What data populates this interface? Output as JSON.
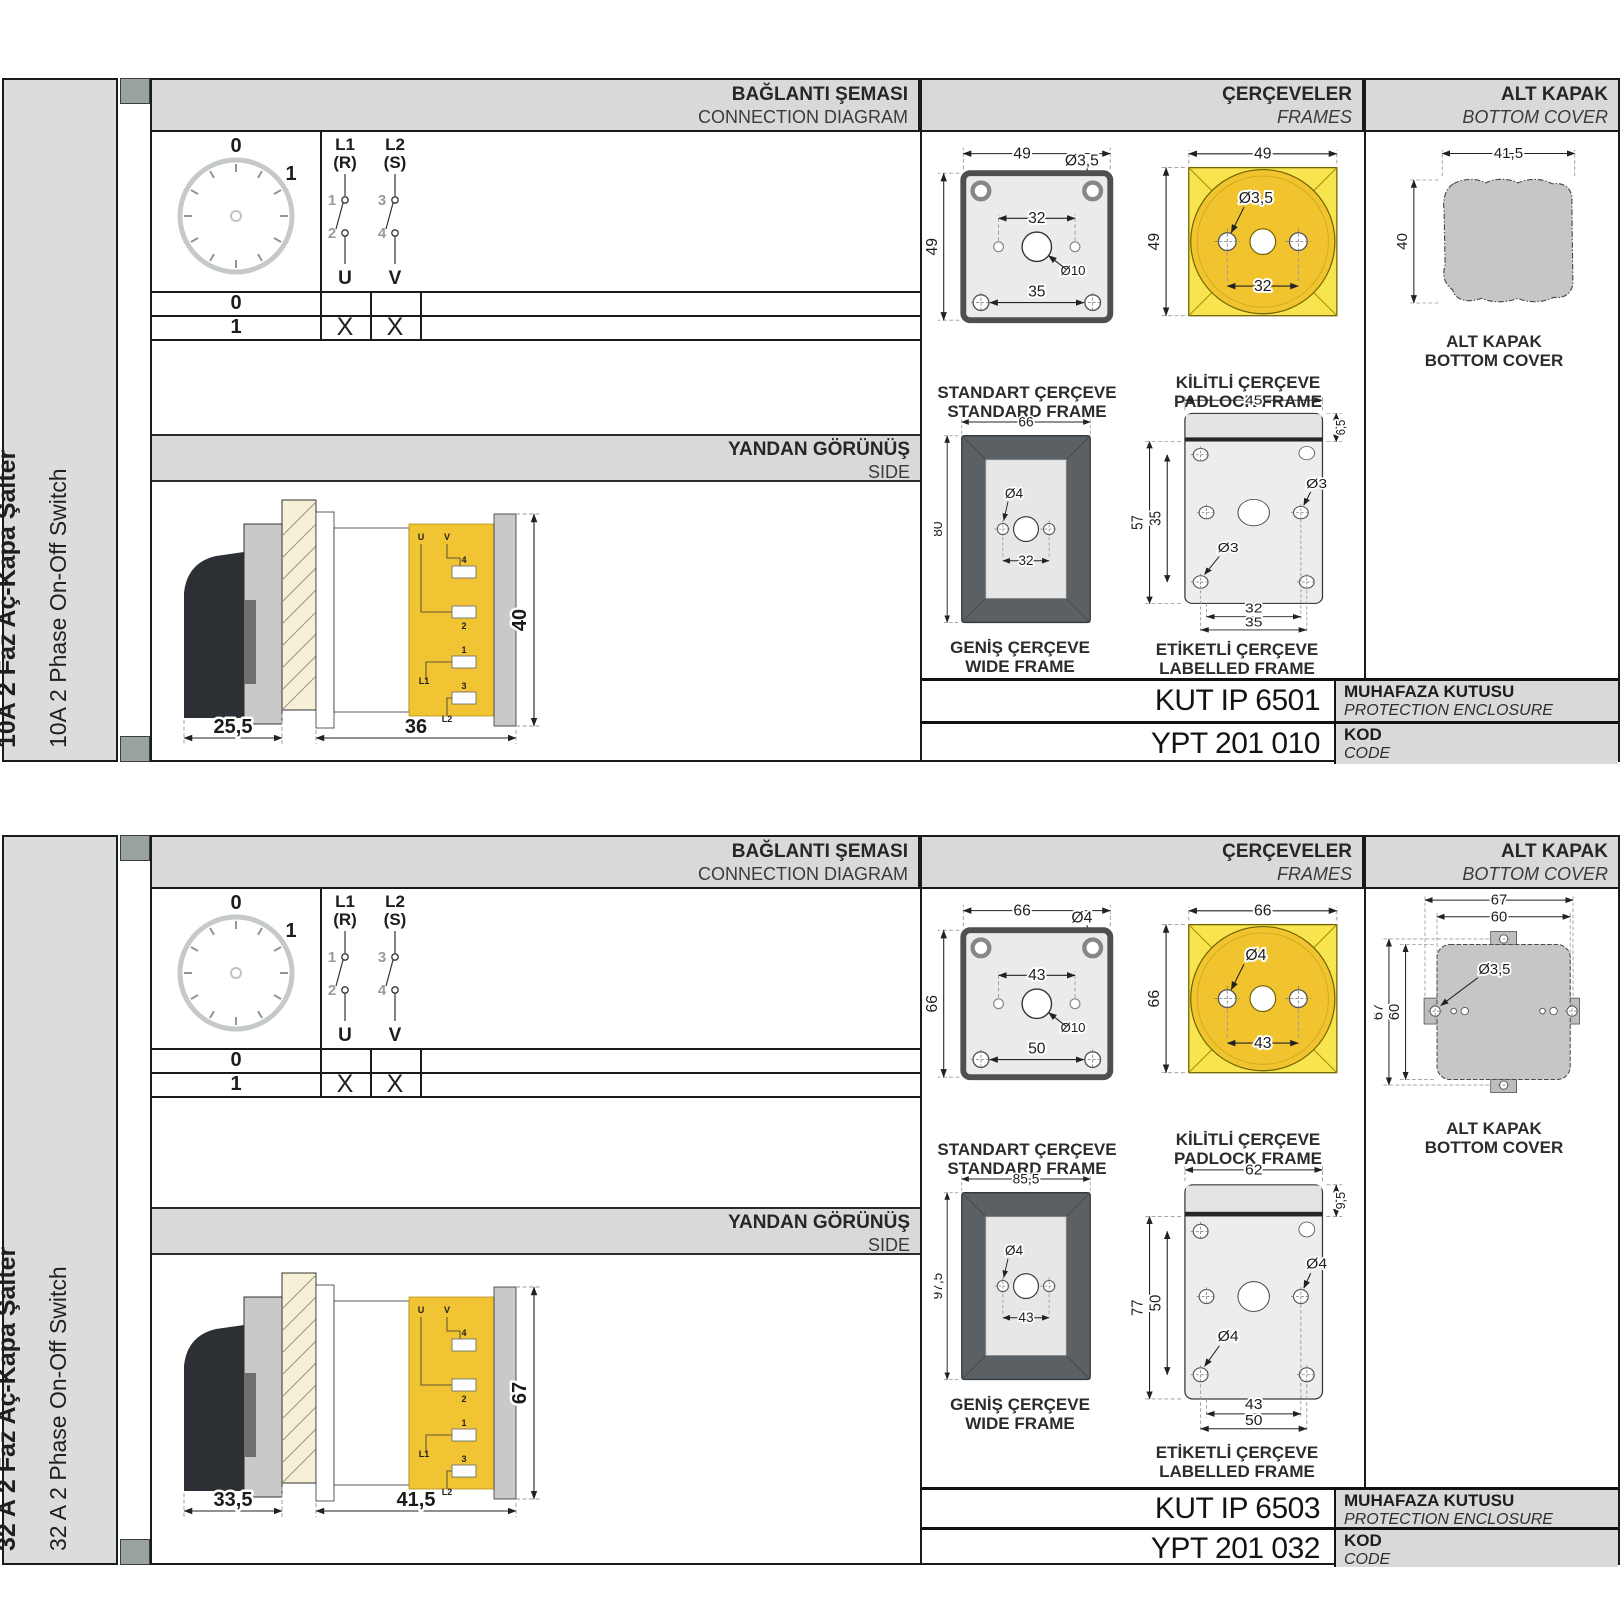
{
  "colors": {
    "panel_gray": "#d9d9d9",
    "accent_yellow": "#f8e44e",
    "accent_gold": "#f1c42f",
    "terminal_yellow": "#f1c433",
    "drawing_gray": "#c6c6c6",
    "frame_dark": "#5b6064",
    "line_black": "#1a1a1a"
  },
  "header": {
    "connection_tr": "BAĞLANTI ŞEMASI",
    "connection_en": "CONNECTION DIAGRAM",
    "frames_tr": "ÇERÇEVELER",
    "frames_en": "FRAMES",
    "cover_tr": "ALT KAPAK",
    "cover_en": "BOTTOM COVER"
  },
  "side_header": {
    "tr": "YANDAN GÖRÜNÜŞ",
    "en": "SIDE"
  },
  "diagram": {
    "pos0": "0",
    "pos1": "1",
    "pole1": "L1",
    "pole1_phase": "(R)",
    "pole2": "L2",
    "pole2_phase": "(S)",
    "c1": "1",
    "c2": "2",
    "c3": "3",
    "c4": "4",
    "t1": "U",
    "t2": "V",
    "row0": "0",
    "row1": "1",
    "x1": "X",
    "x2": "X"
  },
  "side_view_labels": {
    "u": "U",
    "v": "V",
    "n4": "4",
    "n2": "2",
    "n1": "1",
    "n3": "3",
    "l1": "L1",
    "l2": "L2"
  },
  "captions": {
    "standard_tr": "STANDART ÇERÇEVE",
    "standard_en": "STANDARD FRAME",
    "padlock_tr": "KİLİTLİ ÇERÇEVE",
    "padlock_en": "PADLOCK FRAME",
    "wide_tr": "GENİŞ ÇERÇEVE",
    "wide_en": "WIDE FRAME",
    "labelled_tr": "ETİKETLİ ÇERÇEVE",
    "labelled_en": "LABELLED FRAME",
    "cover_tr": "ALT KAPAK",
    "cover_en": "BOTTOM COVER"
  },
  "code_labels": {
    "enclosure_tr": "MUHAFAZA KUTUSU",
    "enclosure_en": "PROTECTION ENCLOSURE",
    "kod_tr": "KOD",
    "kod_en": "CODE"
  },
  "sections": [
    {
      "title_tr": "10A 2 Faz Aç-Kapa Şalter",
      "title_en": "10A 2 Phase On-Off Switch",
      "side_view": {
        "w1": "25,5",
        "w2": "36",
        "h": "40"
      },
      "standard": {
        "w": "49",
        "h": "49",
        "hole": "Ø3,5",
        "span": "32",
        "center": "Ø10",
        "span2": "35"
      },
      "padlock": {
        "w": "49",
        "h": "49",
        "hole": "Ø3,5",
        "span": "32"
      },
      "wide": {
        "w": "66",
        "h": "80",
        "hole": "Ø4",
        "span": "32"
      },
      "labelled": {
        "w": "45",
        "top": "6,5",
        "h": "57",
        "inner": "35",
        "hole_mid": "Ø3",
        "hole_bot": "Ø3",
        "span1": "32",
        "span2": "35"
      },
      "cover": {
        "w": "41,5",
        "h": "40"
      },
      "enclosure_code": "KUT IP 6501",
      "order_code": "YPT 201 010"
    },
    {
      "title_tr": "32 A 2 Faz Aç-Kapa Şalter",
      "title_en": "32 A 2 Phase On-Off Switch",
      "side_view": {
        "w1": "33,5",
        "w2": "41,5",
        "h": "67"
      },
      "standard": {
        "w": "66",
        "h": "66",
        "hole": "Ø4",
        "span": "43",
        "center": "Ø10",
        "span2": "50"
      },
      "padlock": {
        "w": "66",
        "h": "66",
        "hole": "Ø4",
        "span": "43"
      },
      "wide": {
        "w": "85,5",
        "h": "97,5",
        "hole": "Ø4",
        "span": "43"
      },
      "labelled": {
        "w": "62",
        "top": "9,5",
        "h": "77",
        "inner": "50",
        "hole_mid": "Ø4",
        "hole_bot": "Ø4",
        "span1": "43",
        "span2": "50"
      },
      "cover": {
        "w": "67",
        "w2": "60",
        "h": "67",
        "h2": "60",
        "hole": "Ø3,5"
      },
      "enclosure_code": "KUT IP 6503",
      "order_code": "YPT 201 032"
    }
  ]
}
